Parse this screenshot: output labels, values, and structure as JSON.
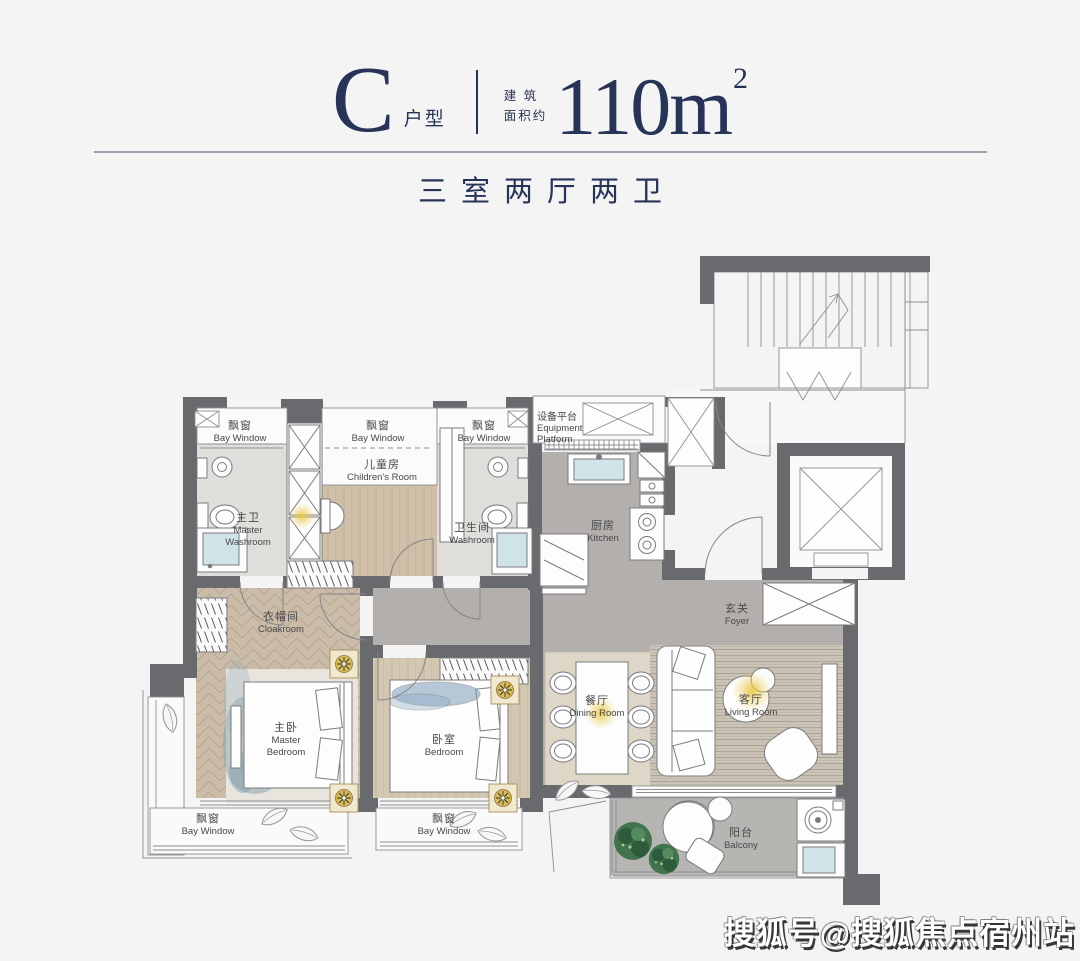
{
  "header": {
    "unit_letter": "C",
    "unit_type_label": "户型",
    "area_prefix_line1": "建 筑",
    "area_prefix_line2": "面积约",
    "area_value": "110m",
    "area_exponent": "2",
    "subtitle": "三室两厅两卫",
    "accent_color": "#273357"
  },
  "floorplan": {
    "wall_color": "#696a6e",
    "gold_color": "#d9ba58",
    "rooms": {
      "bay_window": {
        "zh": "飘窗",
        "en": "Bay Window"
      },
      "master_washroom": {
        "zh": "主卫",
        "en_line1": "Master",
        "en_line2": "Washroom"
      },
      "childrens_room": {
        "zh": "儿童房",
        "en": "Children's Room"
      },
      "washroom": {
        "zh": "卫生间",
        "en": "Washroom"
      },
      "equipment_platform": {
        "zh": "设备平台",
        "en_line1": "Equipment",
        "en_line2": "Platform"
      },
      "kitchen": {
        "zh": "厨房",
        "en": "Kitchen"
      },
      "foyer": {
        "zh": "玄关",
        "en": "Foyer"
      },
      "cloakroom": {
        "zh": "衣帽间",
        "en": "Cloakroom"
      },
      "master_bedroom": {
        "zh": "主卧",
        "en_line1": "Master",
        "en_line2": "Bedroom"
      },
      "bedroom": {
        "zh": "卧室",
        "en": "Bedroom"
      },
      "dining_room": {
        "zh": "餐厅",
        "en": "Dining Room"
      },
      "living_room": {
        "zh": "客厅",
        "en": "Living Room"
      },
      "balcony": {
        "zh": "阳台",
        "en": "Balcony"
      }
    }
  },
  "watermark": {
    "text": "搜狐号@搜狐焦点宿州站"
  }
}
